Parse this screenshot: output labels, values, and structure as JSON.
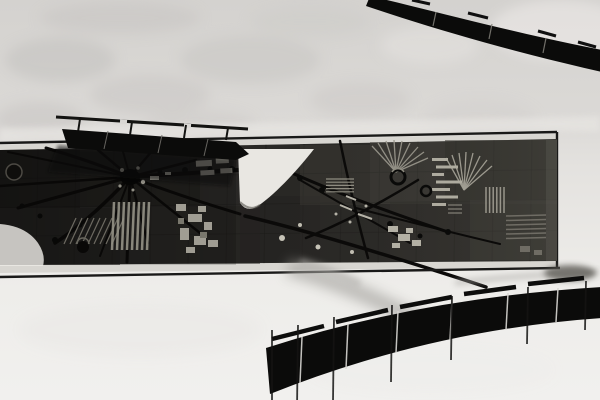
{
  "meta": {
    "type": "black-and-white architectural photograph",
    "description": "Monochrome photo of a modernist building facade: a long abstract sgraffito relief mural band runs across a plastered wall, shaded at upper-left by a straight dark railing, with dark curved balustrade bands sweeping across the top-right and bottom-right corners.",
    "visible_text": "none"
  },
  "palette": {
    "wall_top": "#d5d3d0",
    "wall_bottom": "#f0efec",
    "plaster_bright": "#e7e5e2",
    "frame_strip": "#d8d6d1",
    "frame_line": "#191918",
    "mural_base": "#2b2a27",
    "mural_shadow": "#141311",
    "mural_mid": "#3c3a35",
    "mural_fleck_light": "#b3b0a5",
    "relief_dark": "#0b0a09",
    "white_shape": "#e9e7e2",
    "ironwork_black": "#0b0b0a",
    "cast_shadow": "#a3a19d"
  },
  "scene": {
    "wall": {
      "upper": "mottled sunlit plaster",
      "lower": "smooth bright plaster"
    },
    "mural": {
      "kind": "abstract ceramic sgraffito relief frieze",
      "bounds": "full-width band about y130-277, right end at x557",
      "motifs": [
        "left starburst of radiating dark spokes",
        "right cluster of long crossing arcs",
        "two light sunburst fans",
        "ribbed hatched tiles",
        "incised dark rings",
        "light rubble texture clusters",
        "white sail-shaped inset",
        "white rounded corner inset at lower left"
      ]
    },
    "railings": {
      "upper_left": "straight dark railing slab with thin handrail casting shadow on the mural",
      "upper_right": "segmented dark curved handrail band exiting the top edge",
      "lower_right": "curved dark balustrade with panel joints, thin posts and a gapped handrail"
    }
  }
}
